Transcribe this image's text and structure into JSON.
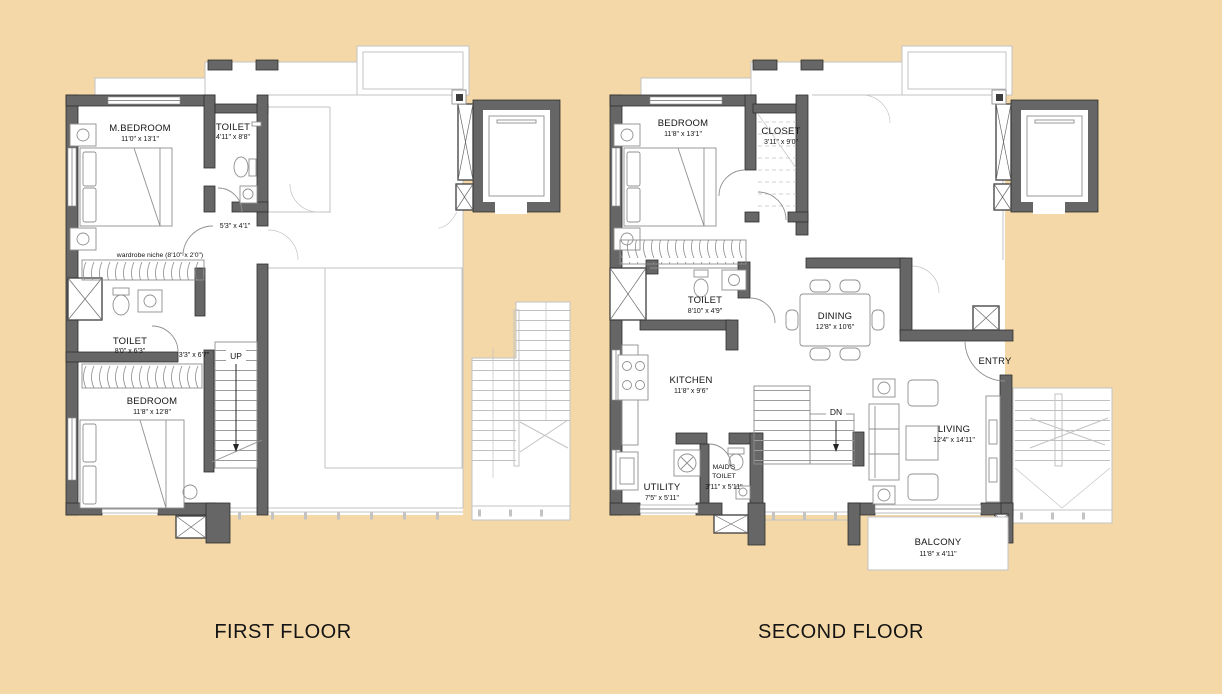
{
  "colors": {
    "bg": "#f5d8a7",
    "wall": "#666666",
    "wallDark": "#2e2e2e",
    "ghost": "#c3c3c3",
    "furn": "#909090",
    "text": "#141414"
  },
  "first_floor": {
    "title": "FIRST FLOOR",
    "rooms": {
      "m_bedroom": {
        "label": "M.BEDROOM",
        "dims": "11'0\" x 13'1\""
      },
      "toilet_a": {
        "label": "TOILET",
        "dims": "4'11\" x 8'8\""
      },
      "lobby": {
        "dims": "5'3\" x 4'1\""
      },
      "wardrobe_niche": {
        "label": "wardrobe niche (8'10\" x 2'0\")"
      },
      "toilet_b": {
        "label": "TOILET",
        "dims": "8'0\" x 6'3\""
      },
      "passage": {
        "dims": "3'3\" x 6'7\""
      },
      "stair": {
        "label": "UP"
      },
      "bedroom": {
        "label": "BEDROOM",
        "dims": "11'8\" x 12'8\""
      }
    }
  },
  "second_floor": {
    "title": "SECOND FLOOR",
    "rooms": {
      "bedroom": {
        "label": "BEDROOM",
        "dims": "11'8\" x 13'1\""
      },
      "closet": {
        "label": "CLOSET",
        "dims": "3'11\" x 9'0\""
      },
      "toilet": {
        "label": "TOILET",
        "dims": "8'10\" x 4'9\""
      },
      "dining": {
        "label": "DINING",
        "dims": "12'8\" x 10'6\""
      },
      "kitchen": {
        "label": "KITCHEN",
        "dims": "11'8\" x 9'6\""
      },
      "stair": {
        "label": "DN"
      },
      "entry": {
        "label": "ENTRY"
      },
      "living": {
        "label": "LIVING",
        "dims": "12'4\" x 14'11\""
      },
      "utility": {
        "label": "UTILITY",
        "dims": "7'5\" x 5'11\""
      },
      "maids_toilet": {
        "label_line1": "MAID'S",
        "label_line2": "TOILET",
        "dims": "3'11\" x 5'11\""
      },
      "balcony": {
        "label": "BALCONY",
        "dims": "11'8\" x 4'11\""
      }
    }
  }
}
